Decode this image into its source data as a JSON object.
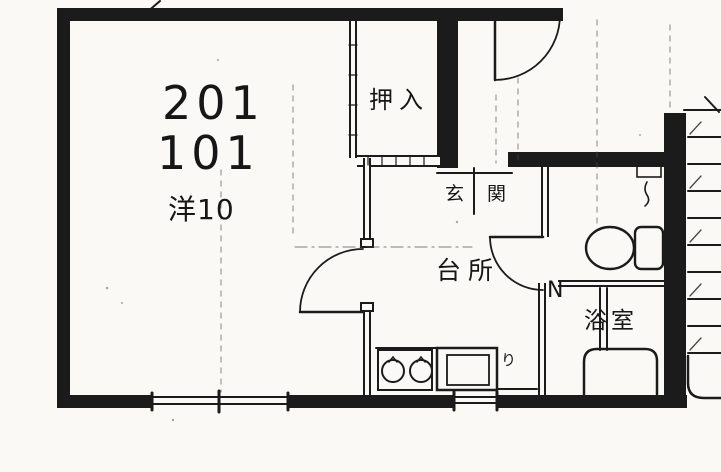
{
  "plan": {
    "labels": {
      "unit_upper": "201",
      "unit_lower": "101",
      "main_room": "洋10",
      "closet": "押入",
      "entrance": "玄関",
      "kitchen": "台所",
      "bathroom": "浴室",
      "door_mark": "N",
      "utility_mark": "り"
    },
    "colors": {
      "ink": "#1b1b1b",
      "paper": "#faf9f5"
    },
    "symbols": {
      "toilet": "toilet-plan-icon",
      "bathtub": "bathtub-plan-icon",
      "washstand": "washstand-plan-icon",
      "stove": "two-burner-stove-icon",
      "sink": "kitchen-sink-icon",
      "stairs": "staircase-icon",
      "doors": "door-swing-arc",
      "window": "sliding-window-symbol"
    }
  }
}
